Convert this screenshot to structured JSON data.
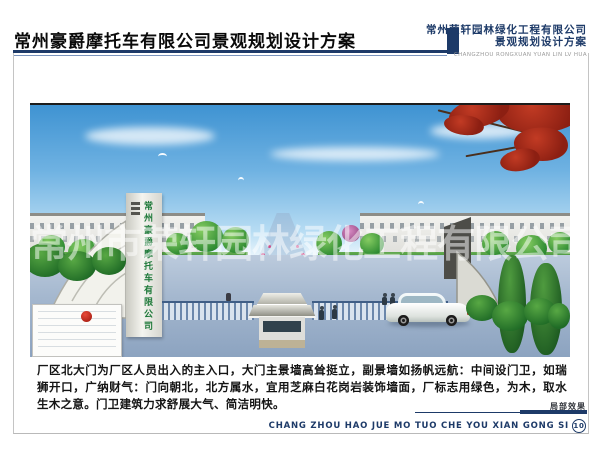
{
  "header": {
    "title": "常州豪爵摩托车有限公司景观规划设计方案",
    "firm_name": "常州荣轩园林绿化工程有限公司",
    "firm_subtitle": "景观规划设计方案",
    "firm_name_en": "CHANGZHOU RONGXUAN YUAN LIN LV HUA"
  },
  "scene": {
    "gate_pylon_text": "常州豪爵摩托车有限公司",
    "watermark_text": "常州市荣轩园林绿化工程有限公司"
  },
  "description": "厂区北大门为厂区人员出入的主入口，大门主景墙高耸挺立，副景墙如扬帆远航：中间设门卫，如瑞狮开口，广纳财气：门向朝北，北方属水，宜用芝麻白花岗岩装饰墙面，厂标志用绿色，为木，取水生木之意。门卫建筑力求舒展大气、简洁明快。",
  "footer": {
    "caption": "局部效果",
    "pinyin": "CHANG ZHOU HAO JUE MO TUO CHE YOU XIAN GONG SI",
    "page_number": "10"
  },
  "colors": {
    "navy": "#1d3a68",
    "sky_top": "#3f93d2",
    "tree_green": "#3f9e3a",
    "maple_red": "#a52819",
    "road_blue_gray": "#93a9c4",
    "sign_text_green": "#1f7a3a"
  }
}
